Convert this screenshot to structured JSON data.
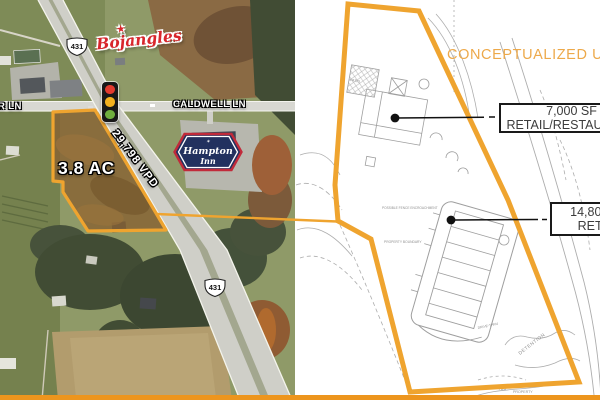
{
  "colors": {
    "accent_orange": "#EFA42F",
    "bottom_bar_orange": "#ED951D",
    "conceptualized_text_orange": "#EDA94A",
    "bojangles_red": "#D8262C",
    "hampton_navy": "#22315F",
    "hampton_red": "#C12A3A",
    "signal_red": "#E23A2E",
    "signal_yellow": "#F2B01E",
    "signal_green": "#6FAE3E"
  },
  "aerial": {
    "route_shields": [
      "431",
      "431"
    ],
    "cross_street_label": "CALDWELL LN",
    "left_street_label": "R LN",
    "traffic_count_label": "29,798 VPD",
    "parcel_area_label": "3.8 AC",
    "bojangles_wordmark": "Bojangles",
    "hampton_inn": {
      "line1": "Hampton",
      "line2": "Inn"
    }
  },
  "icons": {
    "bojangles_star": "★",
    "hampton_ornament": "✶"
  },
  "siteplan": {
    "title": "CONCEPTUALIZED USE",
    "callouts": [
      {
        "size": "7,000 SF",
        "use": "RETAIL/RESTAURANT"
      },
      {
        "size": "14,800 SF",
        "use": "RETAIL"
      }
    ],
    "sketch_labels": {
      "patio": "PATIO",
      "drive_thru": "DRIVE-THRU",
      "detention": "DETENTION",
      "contour": "755",
      "property": "PROPERTY",
      "fence_note": "POSSIBLE FENCE ENCROACHMENT",
      "boundary_note": "PROPERTY BOUNDARY"
    }
  }
}
